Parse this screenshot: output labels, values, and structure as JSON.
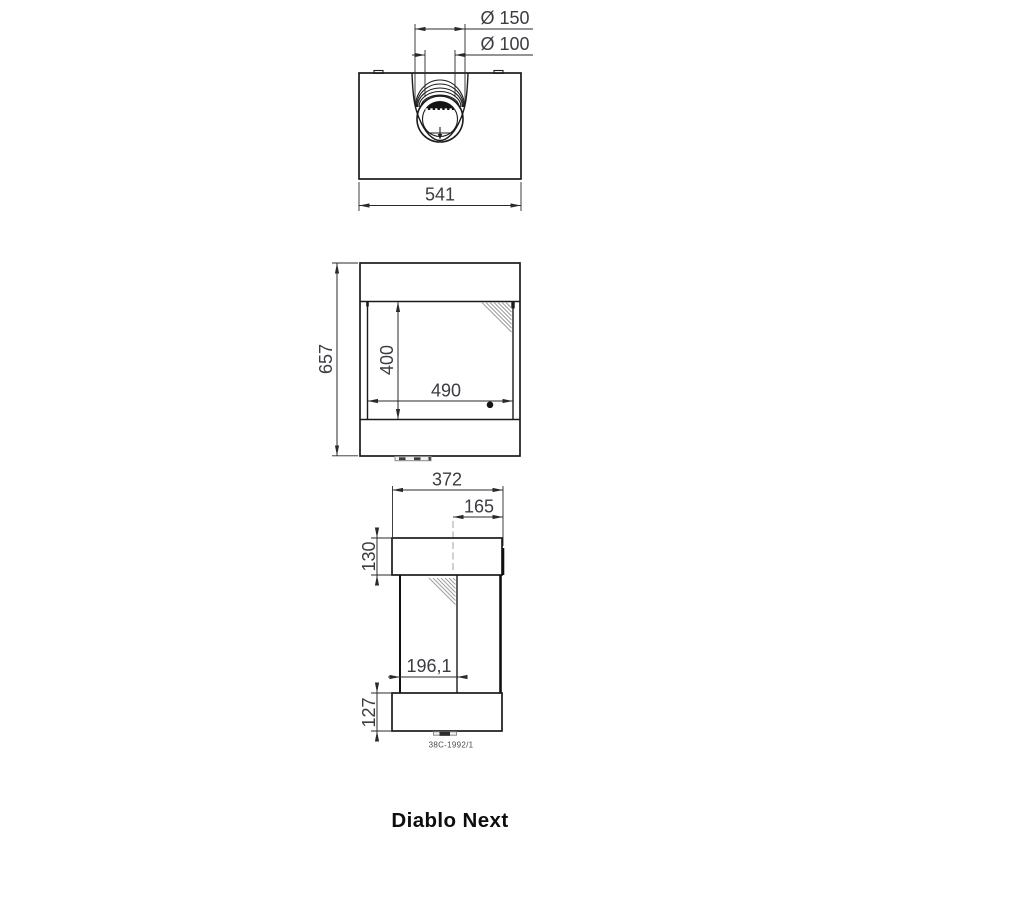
{
  "title": "Diablo Next",
  "drawing_number": "38C-1992/1",
  "colors": {
    "line": "#1b1b1b",
    "dim_text": "#3b3b41",
    "hatch": "#9e9e9e",
    "background": "#ffffff"
  },
  "views": {
    "top": {
      "dims": {
        "flue_outer_diameter": "Ø 150",
        "flue_inner_diameter": "Ø 100",
        "overall_width": "541"
      }
    },
    "front": {
      "dims": {
        "overall_height": "657",
        "glass_height": "400",
        "glass_width": "490"
      }
    },
    "side": {
      "dims": {
        "overall_depth": "372",
        "flue_center_offset": "165",
        "top_section_height": "130",
        "mid_section_depth": "196,1",
        "base_height": "127"
      }
    }
  }
}
